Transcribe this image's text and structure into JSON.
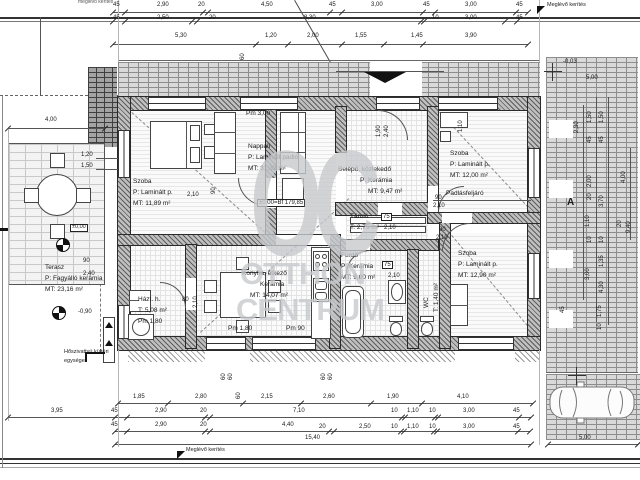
{
  "plan": {
    "fence_top_label": "Meglévő kerítés",
    "fence_topleft_label": "meglévő kerítés",
    "fence_bottom_label": "Meglévő kerítés",
    "section_marker": "A"
  },
  "levels": {
    "zero": "±0,00",
    "zero_bf": "±0,00=Bf 179,85",
    "terrace": "-0,90",
    "site": "-0,03"
  },
  "equipment": {
    "heat_pump_1": "Hőszivattyú kültéri",
    "heat_pump_2": "egysége"
  },
  "watermark": {
    "monogram": "OC",
    "line1": "OTTHON",
    "line2": "CENTRUM"
  },
  "rooms": {
    "szoba_a": {
      "name": "Szoba",
      "floor": "P: Laminált p.",
      "area": "MT: 11,89 m²"
    },
    "nappali": {
      "name": "Nappali",
      "floor": "P: Laminált padló",
      "area": "MT: 31,32 m²",
      "height": "Pm 3,00"
    },
    "belepo": {
      "name": "Belépő, közlekedő",
      "floor": "P: Kerámia",
      "area": "MT: 9,47 m²"
    },
    "szoba_b": {
      "name": "Szoba",
      "floor": "P: Laminált p.",
      "area": "MT: 12,00 m²",
      "extra": "Padlásfeljáró"
    },
    "tarolo": {
      "name": "Tároló",
      "area": "T: 2,75 m²"
    },
    "furdo": {
      "name": "Fürdő",
      "floor": "P: Kerámia",
      "area": "MT: 9,00 m²"
    },
    "wc": {
      "name": "WC",
      "area": "T: 1,40 m²"
    },
    "szoba_c": {
      "name": "Szoba",
      "floor": "P: Laminált p.",
      "area": "MT: 12,90 m²"
    },
    "konyha": {
      "name": "Konyha, étkező",
      "floor": "Kerámia",
      "area": "MT: 14,07 m²",
      "height": "Pm 1,80",
      "height2": "Pm 90"
    },
    "hazt": {
      "name": "Házt. h.",
      "area": "T: 5,08 m²",
      "height": "Pm 1,80"
    },
    "terasz": {
      "name": "Terasz",
      "floor": "P: Fagyálló kerámia",
      "area": "MT: 23,16 m²"
    }
  },
  "dim_labels": [
    {
      "t": "45",
      "x": 113,
      "y": 2
    },
    {
      "t": "2,90",
      "x": 157,
      "y": 2
    },
    {
      "t": "20",
      "x": 198,
      "y": 2
    },
    {
      "t": "4,50",
      "x": 261,
      "y": 2
    },
    {
      "t": "45",
      "x": 329,
      "y": 2
    },
    {
      "t": "3,00",
      "x": 371,
      "y": 2
    },
    {
      "t": "45",
      "x": 423,
      "y": 2
    },
    {
      "t": "3,00",
      "x": 465,
      "y": 2
    },
    {
      "t": "45",
      "x": 516,
      "y": 2
    },
    {
      "t": "45",
      "x": 113,
      "y": 15
    },
    {
      "t": "2,50",
      "x": 157,
      "y": 15
    },
    {
      "t": "20",
      "x": 209,
      "y": 15
    },
    {
      "t": "8,30",
      "x": 304,
      "y": 15
    },
    {
      "t": "10",
      "x": 432,
      "y": 15
    },
    {
      "t": "3,00",
      "x": 465,
      "y": 15
    },
    {
      "t": "45",
      "x": 516,
      "y": 15
    },
    {
      "t": "5,30",
      "x": 175,
      "y": 33
    },
    {
      "t": "1,20",
      "x": 265,
      "y": 33
    },
    {
      "t": "2,00",
      "x": 307,
      "y": 33
    },
    {
      "t": "1,55",
      "x": 355,
      "y": 33
    },
    {
      "t": "1,45",
      "x": 411,
      "y": 33
    },
    {
      "t": "3,90",
      "x": 465,
      "y": 33
    },
    {
      "t": "60",
      "x": 240,
      "y": 60,
      "r": 1
    },
    {
      "t": "4,00",
      "x": 45,
      "y": 117
    },
    {
      "t": "1,20",
      "x": 81,
      "y": 152
    },
    {
      "t": "1,50",
      "x": 81,
      "y": 163
    },
    {
      "t": "90",
      "x": 83,
      "y": 258
    },
    {
      "t": "2,40",
      "x": 83,
      "y": 271
    },
    {
      "t": "2,10",
      "x": 187,
      "y": 192
    },
    {
      "t": "90",
      "x": 211,
      "y": 194,
      "r": 1
    },
    {
      "t": "90",
      "x": 435,
      "y": 195
    },
    {
      "t": "2,10",
      "x": 433,
      "y": 203
    },
    {
      "t": "90",
      "x": 439,
      "y": 227
    },
    {
      "t": "2,10",
      "x": 436,
      "y": 235
    },
    {
      "t": "80",
      "x": 182,
      "y": 297
    },
    {
      "t": "2,10",
      "x": 193,
      "y": 308,
      "r": 1
    },
    {
      "t": "75",
      "x": 381,
      "y": 213,
      "box": 1
    },
    {
      "t": "2,10",
      "x": 384,
      "y": 225
    },
    {
      "t": "75",
      "x": 382,
      "y": 261,
      "box": 1
    },
    {
      "t": "2,10",
      "x": 388,
      "y": 273
    },
    {
      "t": "1,90",
      "x": 376,
      "y": 137,
      "r": 1
    },
    {
      "t": "2,40",
      "x": 384,
      "y": 137,
      "r": 1
    },
    {
      "t": "1,10",
      "x": 458,
      "y": 132,
      "r": 1
    },
    {
      "t": "1,85",
      "x": 133,
      "y": 394
    },
    {
      "t": "2,80",
      "x": 195,
      "y": 394
    },
    {
      "t": "2,15",
      "x": 261,
      "y": 394
    },
    {
      "t": "60",
      "x": 236,
      "y": 399,
      "r": 1
    },
    {
      "t": "2,60",
      "x": 323,
      "y": 394
    },
    {
      "t": "1,90",
      "x": 387,
      "y": 394
    },
    {
      "t": "4,10",
      "x": 457,
      "y": 394
    },
    {
      "t": "3,95",
      "x": 51,
      "y": 408
    },
    {
      "t": "45",
      "x": 111,
      "y": 408
    },
    {
      "t": "2,90",
      "x": 155,
      "y": 408
    },
    {
      "t": "20",
      "x": 200,
      "y": 408
    },
    {
      "t": "7,10",
      "x": 293,
      "y": 408
    },
    {
      "t": "10",
      "x": 391,
      "y": 408
    },
    {
      "t": "1,10",
      "x": 407,
      "y": 408
    },
    {
      "t": "10",
      "x": 429,
      "y": 408
    },
    {
      "t": "3,00",
      "x": 463,
      "y": 408
    },
    {
      "t": "45",
      "x": 513,
      "y": 408
    },
    {
      "t": "45",
      "x": 111,
      "y": 422
    },
    {
      "t": "2,90",
      "x": 155,
      "y": 422
    },
    {
      "t": "20",
      "x": 200,
      "y": 422
    },
    {
      "t": "4,40",
      "x": 282,
      "y": 422
    },
    {
      "t": "20",
      "x": 319,
      "y": 424
    },
    {
      "t": "2,50",
      "x": 359,
      "y": 424
    },
    {
      "t": "10",
      "x": 391,
      "y": 424
    },
    {
      "t": "1,10",
      "x": 407,
      "y": 424
    },
    {
      "t": "10",
      "x": 429,
      "y": 424
    },
    {
      "t": "3,00",
      "x": 463,
      "y": 424
    },
    {
      "t": "45",
      "x": 513,
      "y": 424
    },
    {
      "t": "15,40",
      "x": 305,
      "y": 435
    },
    {
      "t": "5,00",
      "x": 579,
      "y": 435
    },
    {
      "t": "60",
      "x": 221,
      "y": 380,
      "r": 1
    },
    {
      "t": "60",
      "x": 228,
      "y": 380,
      "r": 1
    },
    {
      "t": "60",
      "x": 321,
      "y": 380,
      "r": 1
    },
    {
      "t": "60",
      "x": 328,
      "y": 380,
      "r": 1
    },
    {
      "t": "5,00",
      "x": 586,
      "y": 75
    },
    {
      "t": "2,30",
      "x": 574,
      "y": 133,
      "r": 1
    },
    {
      "t": "1,50",
      "x": 587,
      "y": 123,
      "r": 1
    },
    {
      "t": "1,50",
      "x": 599,
      "y": 123,
      "r": 1
    },
    {
      "t": "45",
      "x": 587,
      "y": 143,
      "r": 1
    },
    {
      "t": "45",
      "x": 599,
      "y": 143,
      "r": 1
    },
    {
      "t": "2,00",
      "x": 587,
      "y": 187,
      "r": 1
    },
    {
      "t": "4,00",
      "x": 621,
      "y": 183,
      "r": 1
    },
    {
      "t": "20",
      "x": 587,
      "y": 200,
      "r": 1
    },
    {
      "t": "3,70",
      "x": 599,
      "y": 207,
      "r": 1
    },
    {
      "t": "1,10",
      "x": 585,
      "y": 227,
      "r": 1
    },
    {
      "t": "9,40",
      "x": 626,
      "y": 233,
      "r": 1
    },
    {
      "t": "20",
      "x": 617,
      "y": 227,
      "r": 1
    },
    {
      "t": "10",
      "x": 587,
      "y": 243,
      "r": 1
    },
    {
      "t": "10",
      "x": 599,
      "y": 243,
      "r": 1
    },
    {
      "t": "1,35",
      "x": 599,
      "y": 267,
      "r": 1
    },
    {
      "t": "3,00",
      "x": 585,
      "y": 280,
      "r": 1
    },
    {
      "t": "4,30",
      "x": 599,
      "y": 293,
      "r": 1
    },
    {
      "t": "1,75",
      "x": 597,
      "y": 317,
      "r": 1
    },
    {
      "t": "10",
      "x": 597,
      "y": 330,
      "r": 1
    },
    {
      "t": "45",
      "x": 560,
      "y": 313,
      "r": 1
    }
  ],
  "ticks": [
    {
      "y": 12,
      "xs": [
        113,
        125,
        203,
        208,
        330,
        342,
        423,
        435,
        516,
        528
      ]
    },
    {
      "y": 21,
      "xs": [
        113,
        125,
        192,
        197,
        421,
        424,
        505,
        517
      ]
    },
    {
      "y": 44,
      "xs": [
        113,
        256,
        288,
        342,
        384,
        423,
        528
      ]
    },
    {
      "y": 128,
      "xs": [
        8,
        105
      ]
    },
    {
      "y": 403,
      "xs": [
        118,
        168,
        243,
        301,
        371,
        422,
        533
      ]
    },
    {
      "y": 417,
      "xs": [
        8,
        115,
        127,
        205,
        210,
        402,
        405,
        435,
        438,
        519,
        531
      ]
    },
    {
      "y": 431,
      "xs": [
        115,
        127,
        205,
        210,
        329,
        334,
        401,
        404,
        434,
        437,
        518,
        530
      ]
    },
    {
      "y": 444,
      "xs": [
        115,
        531,
        548,
        638
      ]
    }
  ]
}
